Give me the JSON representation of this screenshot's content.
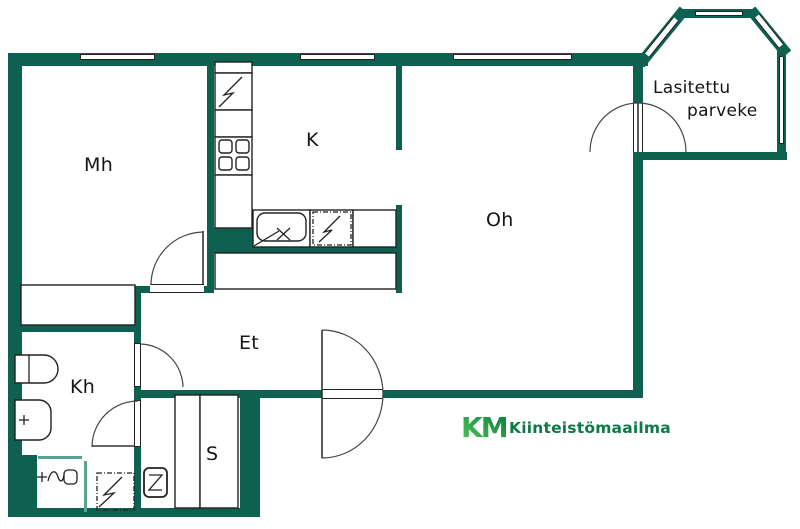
{
  "floor_plan": {
    "rooms": [
      {
        "id": "mh",
        "label": "Mh"
      },
      {
        "id": "k",
        "label": "K"
      },
      {
        "id": "oh",
        "label": "Oh"
      },
      {
        "id": "et",
        "label": "Et"
      },
      {
        "id": "kh",
        "label": "Kh"
      },
      {
        "id": "s",
        "label": "S"
      }
    ],
    "balcony": {
      "label_line1": "Lasitettu",
      "label_line2": "parveke"
    },
    "branding": {
      "logo_text": "KM",
      "company": "Kiinteistömaailma"
    },
    "colors": {
      "wall": "#0E6150",
      "glass_partition": "#59A193",
      "logo_green_dark": "#0B7A44",
      "logo_green_light": "#52C855",
      "line": "#222222",
      "background": "#FFFFFF"
    },
    "icons": {
      "electric_appliance": "lightning-zigzag",
      "stove": "four-rounded-burners",
      "kitchen_sink": "rounded-basin-with-x",
      "door_swing": "quarter-arc",
      "shower_mixer": "plus-wave-box",
      "sauna_heater": "rounded-z-box",
      "toilet": "tank-and-bowl",
      "washbasin": "rounded-basin-plus"
    }
  }
}
